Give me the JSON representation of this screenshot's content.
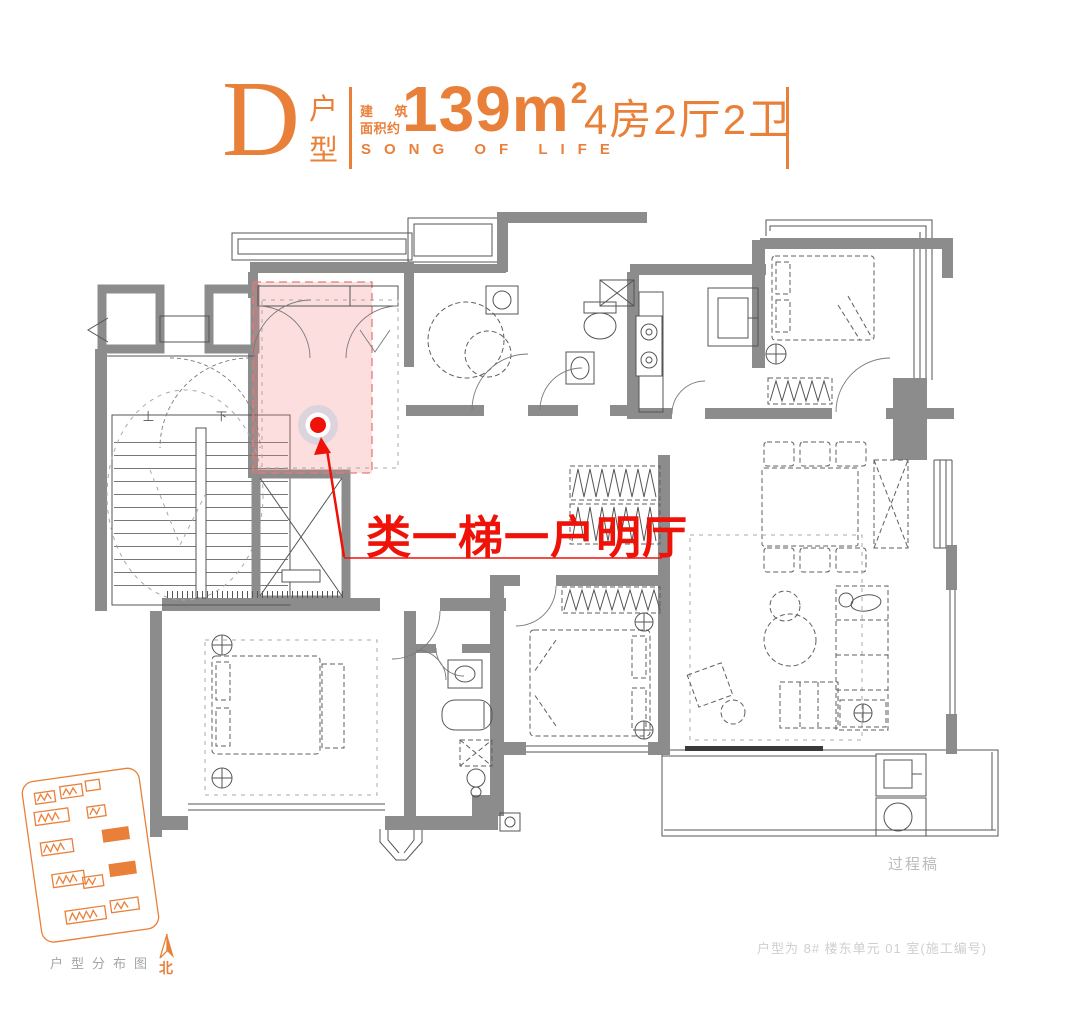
{
  "header": {
    "letter": "D",
    "letter_label_top": "户",
    "letter_label_bottom": "型",
    "area_prefix_line1": "建 筑",
    "area_prefix_line2": "面积约",
    "area_value": "139",
    "area_unit": "m",
    "area_exponent": "2",
    "spec": "4房2厅2卫",
    "subtitle": "SONG OF LIFE"
  },
  "plan": {
    "annotation": "类一梯一户明厅",
    "stairs_up_label": "上",
    "stairs_down_label": "下",
    "watermark": "过程稿",
    "footnote": "户型为 8# 楼东单元 01 室(施工编号)"
  },
  "sitemap": {
    "label": "户型分布图",
    "north_label": "北"
  },
  "colors": {
    "accent": "#e9803a",
    "red": "#ee1208",
    "wall": "#8c8c8c",
    "line": "#555555",
    "muted": "#bcbcbc",
    "faint": "#cfcfcf",
    "highlight": "rgba(238,128,122,0.26)",
    "glow": "rgba(150,190,220,0.30)"
  }
}
